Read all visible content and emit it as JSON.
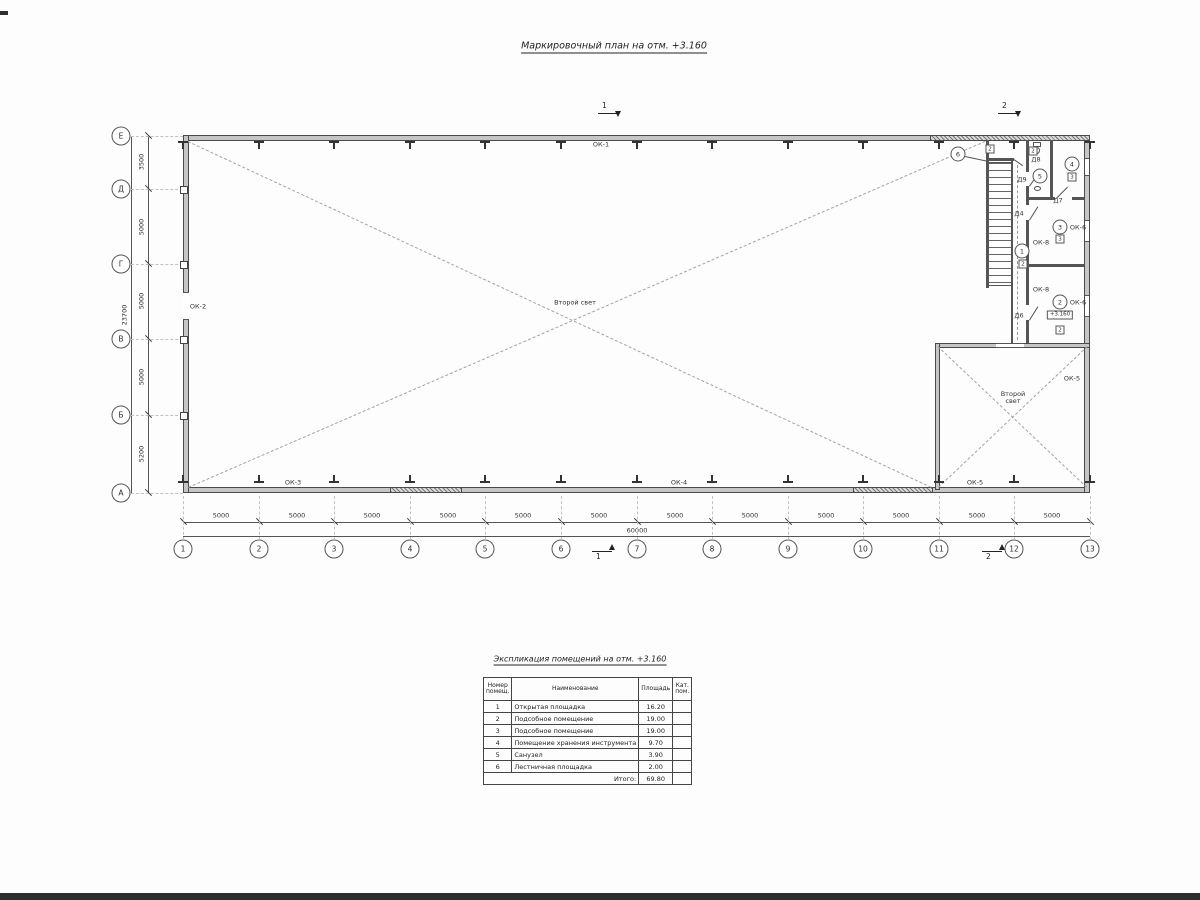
{
  "title": "Маркировочный план на отм. +3.160",
  "plan": {
    "axes": {
      "cols": [
        "1",
        "2",
        "3",
        "4",
        "5",
        "6",
        "7",
        "8",
        "9",
        "10",
        "11",
        "12",
        "13"
      ],
      "col_dims": [
        "5000",
        "5000",
        "5000",
        "5000",
        "5000",
        "5000",
        "5000",
        "5000",
        "5000",
        "5000",
        "5000",
        "5000"
      ],
      "col_total": "60000",
      "rows": [
        "Е",
        "Д",
        "Г",
        "В",
        "Б",
        "А"
      ],
      "row_dims": [
        "3500",
        "5000",
        "5000",
        "5000",
        "5200"
      ],
      "row_total": "23700"
    },
    "sections": {
      "top1": "1",
      "top2": "2",
      "bottom1": "1",
      "bottom2": "2"
    },
    "labels": {
      "ok1": "ОК-1",
      "ok2": "ОК-2",
      "ok3": "ОК-3",
      "ok4": "ОК-4",
      "ok5_right": "ОК-5",
      "ok5_bottom": "ОК-5",
      "ok6_room3": "ОК-6",
      "ok6_room2": "ОК-6",
      "ok8_a": "ОК-8",
      "ok8_b": "ОК-8",
      "second_light_main": "Второй свет",
      "second_light_small": "Второй свет",
      "elevation": "+3.160",
      "doors": {
        "d4": "Д4",
        "d6": "Д6",
        "d7": "Д7",
        "d8": "Д8",
        "d9": "Д9"
      },
      "rooms": {
        "r1": "1",
        "r2": "2",
        "r3": "3",
        "r4": "4",
        "r5": "5",
        "r6": "6"
      },
      "cats": {
        "c1": "2",
        "c2": "2",
        "c3": "3",
        "c4": "3",
        "c5": "2",
        "c6": "2"
      }
    }
  },
  "table": {
    "title": "Экспликация помещений на отм. +3.160",
    "headers": {
      "num": "Номер помещ.",
      "name": "Наименование",
      "area": "Площадь",
      "cat": "Кат. пом."
    },
    "rows": [
      [
        "1",
        "Открытая площадка",
        "16.20",
        ""
      ],
      [
        "2",
        "Подсобное помещение",
        "19.00",
        ""
      ],
      [
        "3",
        "Подсобное помещение",
        "19.00",
        ""
      ],
      [
        "4",
        "Помещение хранения инструмента",
        "9.70",
        ""
      ],
      [
        "5",
        "Санузел",
        "3.90",
        ""
      ],
      [
        "6",
        "Лестничная площадка",
        "2.00",
        ""
      ]
    ],
    "total_label": "Итого:",
    "total_value": "69.80"
  }
}
